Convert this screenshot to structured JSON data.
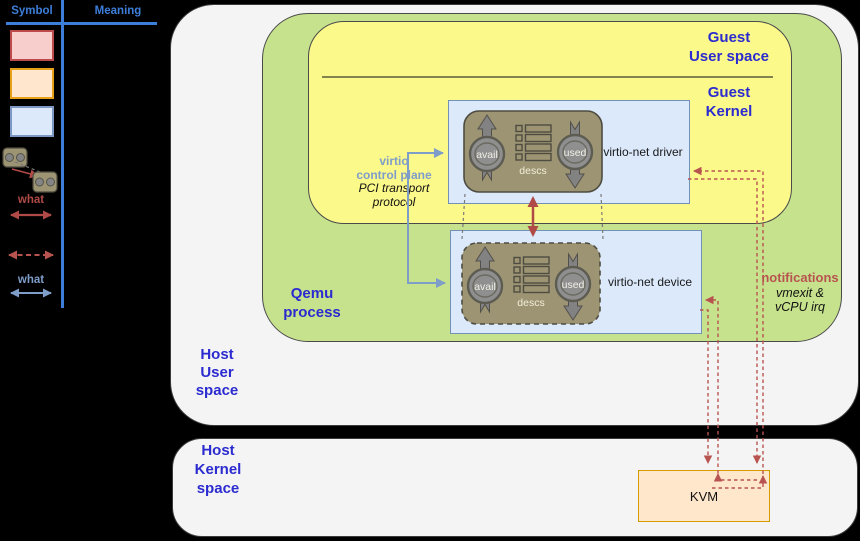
{
  "colors": {
    "background": "#000000",
    "host_fill": "#f4f4f4",
    "qemu_fill": "#c6e28d",
    "guest_fill": "#fcf98b",
    "box_blue_fill": "#dbe9fb",
    "box_blue_border": "#7191b9",
    "vring_fill": "#9d9474",
    "vring_border": "#4e4c40",
    "blue_label": "#2b2bd0",
    "control_blue": "#7e9dc8",
    "notify_red": "#b85450",
    "datapath_red": "#b04a47",
    "kvm_fill": "#ffe7cc",
    "kvm_border": "#d79b00",
    "legend_blue": "#3d7edb",
    "swatch_pink_fill": "#f8cecc",
    "swatch_pink_border": "#bd4a4a",
    "swatch_orange_fill": "#ffe6cc",
    "swatch_orange_border": "#e7a118",
    "swatch_blue_fill": "#dbe9fb",
    "swatch_blue_border": "#7d97c4"
  },
  "legend": {
    "header_symbol": "Symbol",
    "header_meaning": "Meaning",
    "what_red": "what",
    "what_blue": "what"
  },
  "regions": {
    "guest_user_line1": "Guest",
    "guest_user_line2": "User space",
    "guest_kernel_line1": "Guest",
    "guest_kernel_line2": "Kernel",
    "qemu_line1": "Qemu",
    "qemu_line2": "process",
    "host_user_line1": "Host",
    "host_user_line2": "User",
    "host_user_line3": "space",
    "host_kernel_line1": "Host",
    "host_kernel_line2": "Kernel",
    "host_kernel_line3": "space"
  },
  "driver": {
    "label": "virtio-net driver",
    "avail": "avail",
    "used": "used",
    "descs": "descs"
  },
  "device": {
    "label": "virtio-net device",
    "avail": "avail",
    "used": "used",
    "descs": "descs"
  },
  "annotations": {
    "control_line1": "virtio",
    "control_line2": "control plane",
    "control_line3": "PCI transport",
    "control_line4": "protocol",
    "notif_line1": "notifications",
    "notif_line2": "vmexit &",
    "notif_line3": "vCPU irq"
  },
  "kvm": {
    "label": "KVM"
  }
}
